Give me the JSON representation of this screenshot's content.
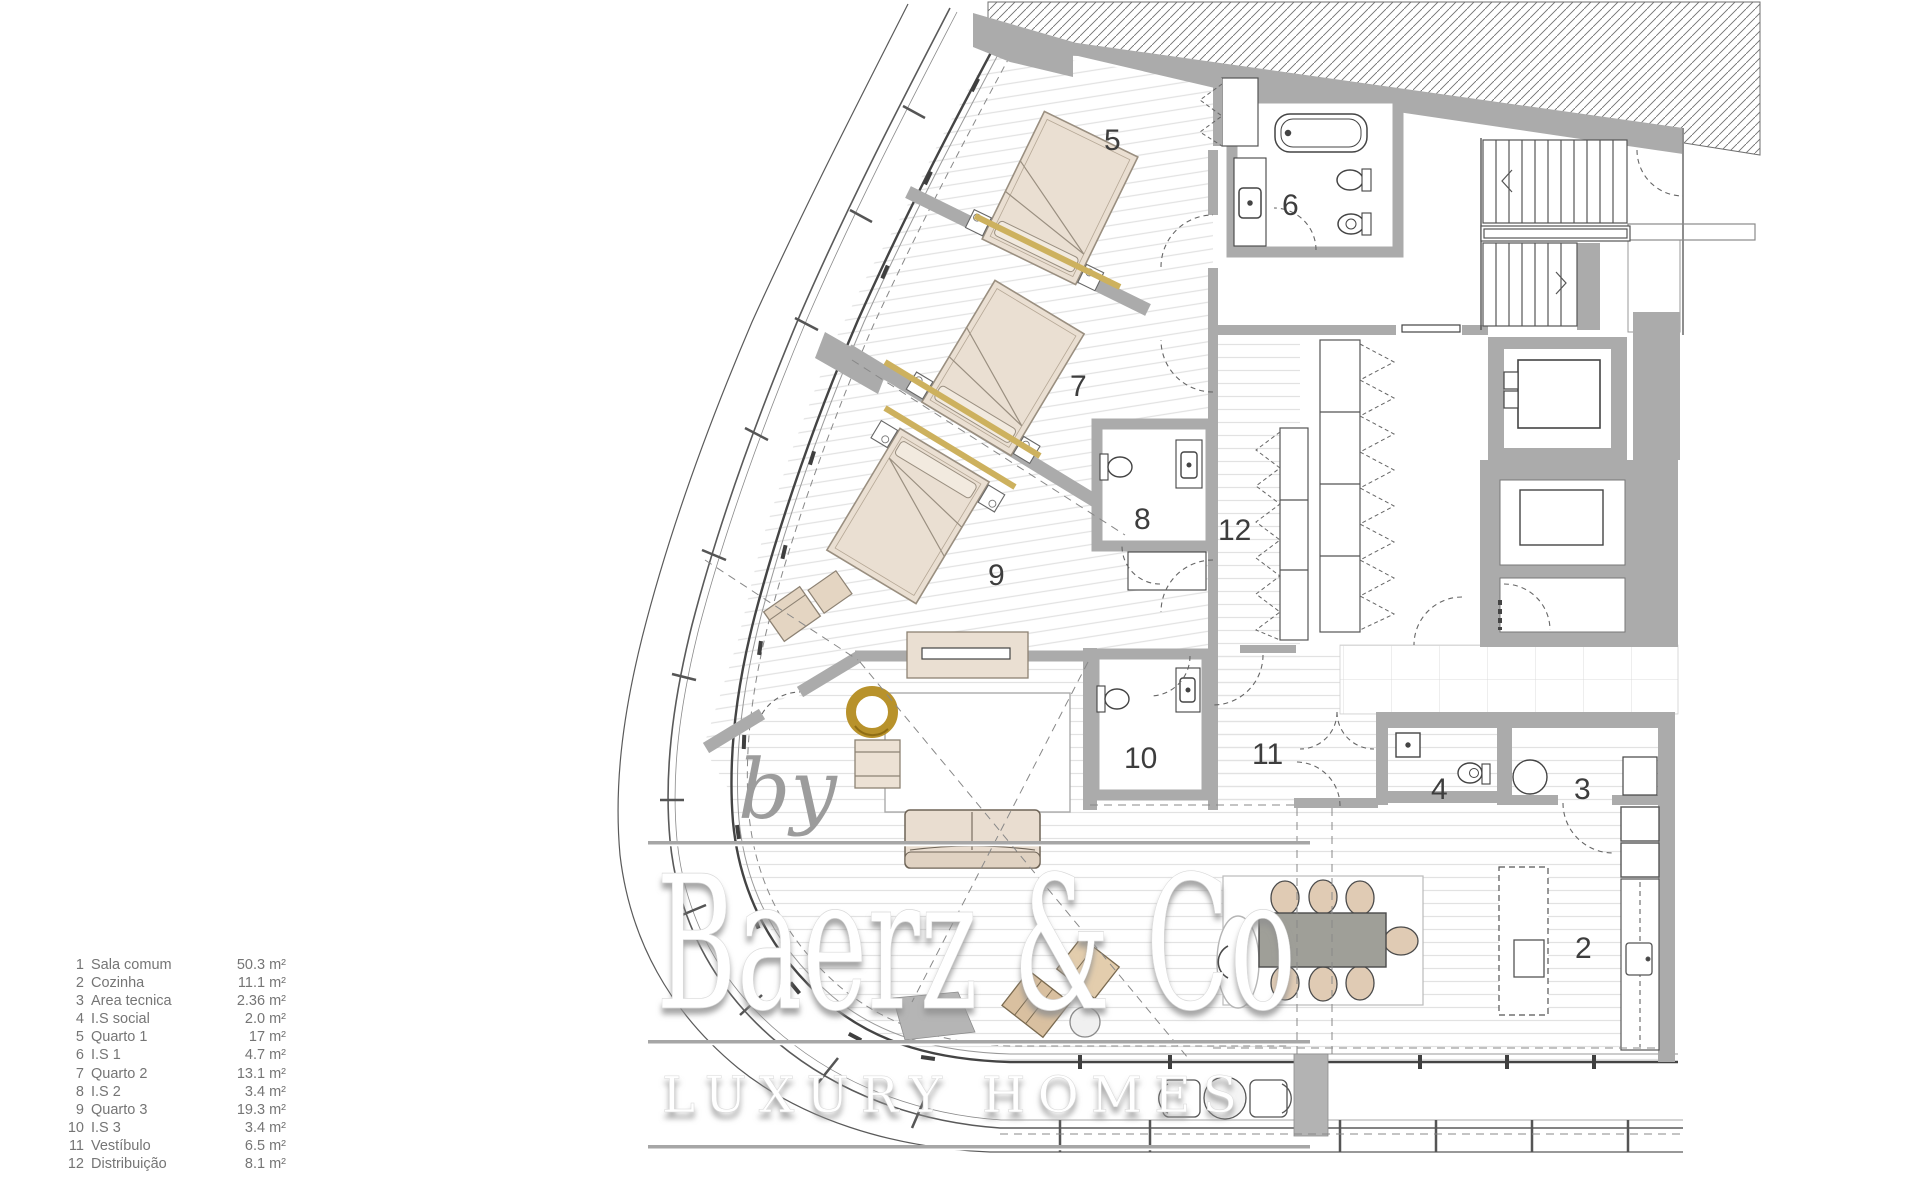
{
  "legend": {
    "items": [
      {
        "num": "1",
        "label": "Sala comum",
        "area": "50.3 m²"
      },
      {
        "num": "2",
        "label": "Cozinha",
        "area": "11.1 m²"
      },
      {
        "num": "3",
        "label": "Area tecnica",
        "area": "2.36 m²"
      },
      {
        "num": "4",
        "label": "I.S social",
        "area": "2.0 m²"
      },
      {
        "num": "5",
        "label": "Quarto 1",
        "area": "17 m²"
      },
      {
        "num": "6",
        "label": "I.S 1",
        "area": "4.7 m²"
      },
      {
        "num": "7",
        "label": "Quarto 2",
        "area": "13.1 m²"
      },
      {
        "num": "8",
        "label": "I.S 2",
        "area": "3.4 m²"
      },
      {
        "num": "9",
        "label": "Quarto 3",
        "area": "19.3 m²"
      },
      {
        "num": "10",
        "label": "I.S 3",
        "area": "3.4 m²"
      },
      {
        "num": "11",
        "label": "Vestíbulo",
        "area": "6.5 m²"
      },
      {
        "num": "12",
        "label": "Distribuição",
        "area": "8.1 m²"
      }
    ]
  },
  "plan": {
    "labels": {
      "quarto1": "5",
      "is1": "6",
      "quarto2": "7",
      "is2": "8",
      "quarto3": "9",
      "is3": "10",
      "vestibulo": "11",
      "distribuicao": "12",
      "is_social": "4",
      "area_tecnica": "3",
      "cozinha": "2"
    }
  },
  "watermark": {
    "by": "by",
    "brand": "Baerz & Co",
    "tagline": "LUXURY HOMES"
  },
  "colors": {
    "wall_gray": "#ababab",
    "floor_stripe": "#e0e0e0",
    "line_dark": "#4a4a4a",
    "bed_beige": "#eadfd2",
    "tan": "#d9c0a0",
    "gold_ring": "#b8922b",
    "gold_strip": "#cdb15e",
    "table_gray": "#9f9f98",
    "legend_text": "#757575"
  }
}
